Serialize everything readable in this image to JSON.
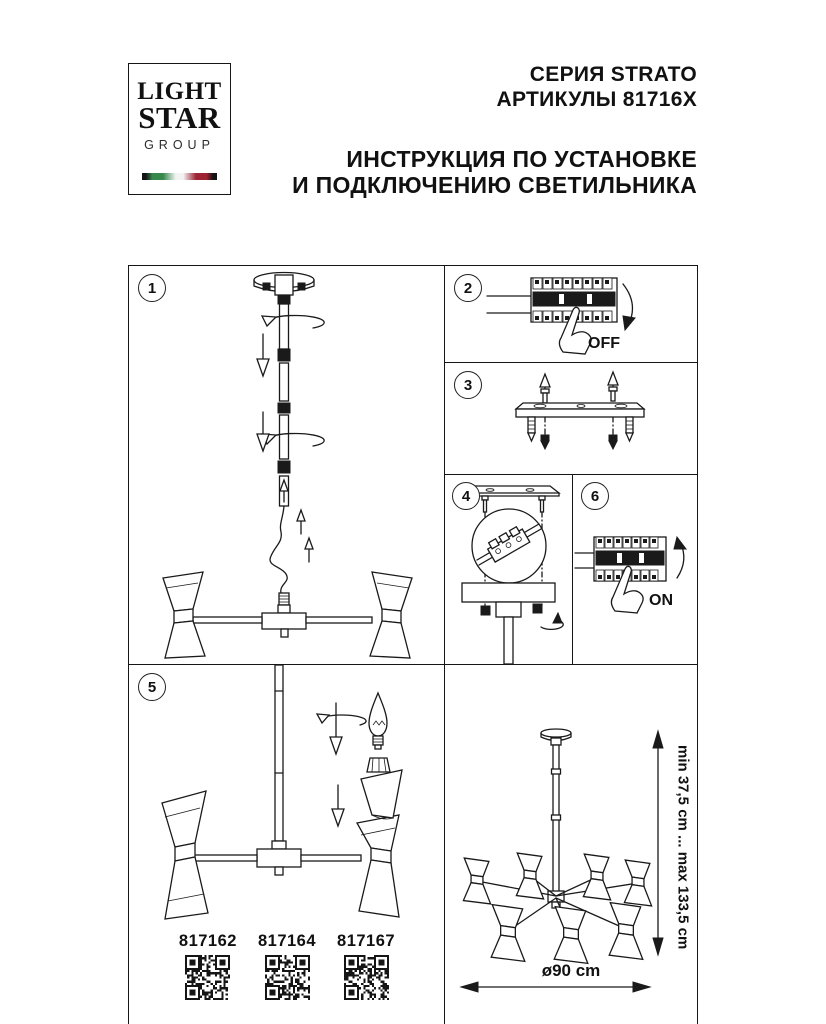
{
  "logo": {
    "line1": "LIGHT",
    "line2": "STAR",
    "line3": "GROUP"
  },
  "header": {
    "series": "СЕРИЯ STRATO",
    "articles": "АРТИКУЛЫ 81716X",
    "instruction_line1": "ИНСТРУКЦИЯ ПО УСТАНОВКЕ",
    "instruction_line2": "И ПОДКЛЮЧЕНИЮ СВЕТИЛЬНИКА"
  },
  "steps": {
    "s1": "1",
    "s2": "2",
    "s3": "3",
    "s4": "4",
    "s5": "5",
    "s6": "6"
  },
  "labels": {
    "off": "OFF",
    "on": "ON"
  },
  "dimensions": {
    "height_range": "min 37,5 cm ... max 133,5 cm",
    "diameter": "ø90 cm"
  },
  "articles": [
    "817162",
    "817164",
    "817167"
  ],
  "colors": {
    "line": "#1a1a1a",
    "flag_green": "#37884d",
    "flag_red": "#9e2433"
  }
}
